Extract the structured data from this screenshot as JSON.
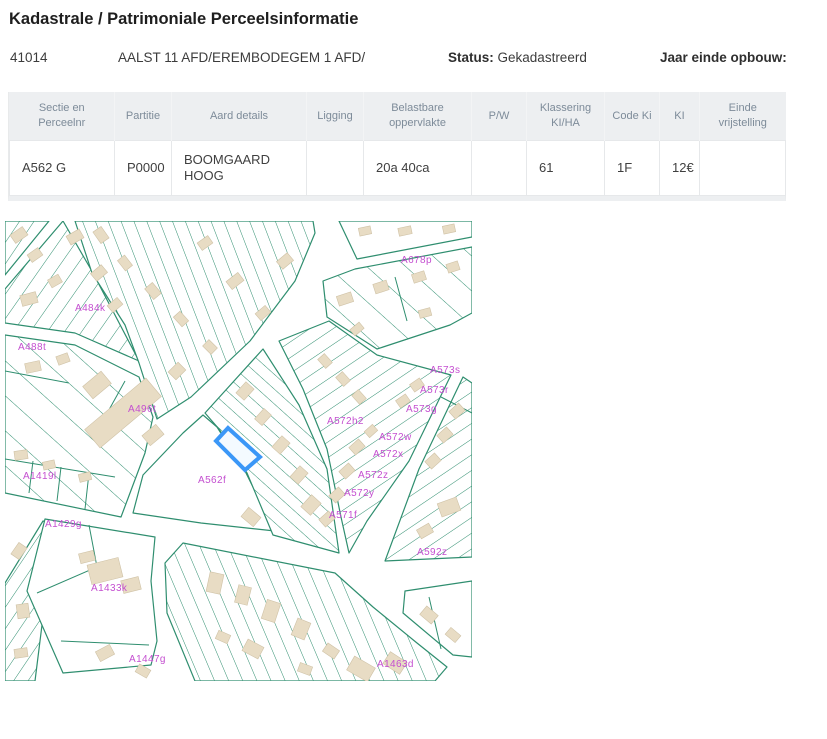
{
  "page": {
    "title": "Kadastrale / Patrimoniale Perceelsinformatie"
  },
  "info": {
    "municipality_code": "41014",
    "division": "AALST 11 AFD/EREMBODEGEM 1 AFD/",
    "status_label": "Status:",
    "status_value": "Gekadastreerd",
    "year_label": "Jaar einde opbouw:"
  },
  "table": {
    "columns": [
      "Sectie en Perceelnr",
      "Partitie",
      "Aard details",
      "Ligging",
      "Belastbare oppervlakte",
      "P/W",
      "Klassering KI/HA",
      "Code Ki",
      "KI",
      "Einde vrijstelling"
    ],
    "rows": [
      [
        "A562 G",
        "P0000",
        "BOOMGAARD HOOG",
        "",
        "20a 40ca",
        "",
        "61",
        "1F",
        "12€",
        ""
      ]
    ]
  },
  "map": {
    "highlighted_parcel": "A562 G",
    "colors": {
      "parcel_line": "#2f8e6f",
      "building_fill": "#e8dcc4",
      "building_stroke": "#cfc2a6",
      "label": "#c44fd0",
      "highlight": "#3b97f7"
    },
    "labels": [
      {
        "text": "A678p",
        "x": 396,
        "y": 42
      },
      {
        "text": "A484k",
        "x": 70,
        "y": 90
      },
      {
        "text": "A488t",
        "x": 13,
        "y": 129
      },
      {
        "text": "A496t",
        "x": 123,
        "y": 191
      },
      {
        "text": "A573s",
        "x": 425,
        "y": 152
      },
      {
        "text": "A573r",
        "x": 415,
        "y": 172
      },
      {
        "text": "A573g",
        "x": 401,
        "y": 191
      },
      {
        "text": "A572h2",
        "x": 322,
        "y": 203
      },
      {
        "text": "A572w",
        "x": 374,
        "y": 219
      },
      {
        "text": "A572x",
        "x": 368,
        "y": 236
      },
      {
        "text": "A572z",
        "x": 353,
        "y": 257
      },
      {
        "text": "A572y",
        "x": 339,
        "y": 275
      },
      {
        "text": "A571f",
        "x": 324,
        "y": 297
      },
      {
        "text": "A592z",
        "x": 412,
        "y": 334
      },
      {
        "text": "A562f",
        "x": 193,
        "y": 262
      },
      {
        "text": "A1419l",
        "x": 18,
        "y": 258
      },
      {
        "text": "A1429g",
        "x": 40,
        "y": 306
      },
      {
        "text": "A1433k",
        "x": 86,
        "y": 370
      },
      {
        "text": "A1447g",
        "x": 124,
        "y": 441
      },
      {
        "text": "A1463d",
        "x": 372,
        "y": 446
      }
    ]
  }
}
